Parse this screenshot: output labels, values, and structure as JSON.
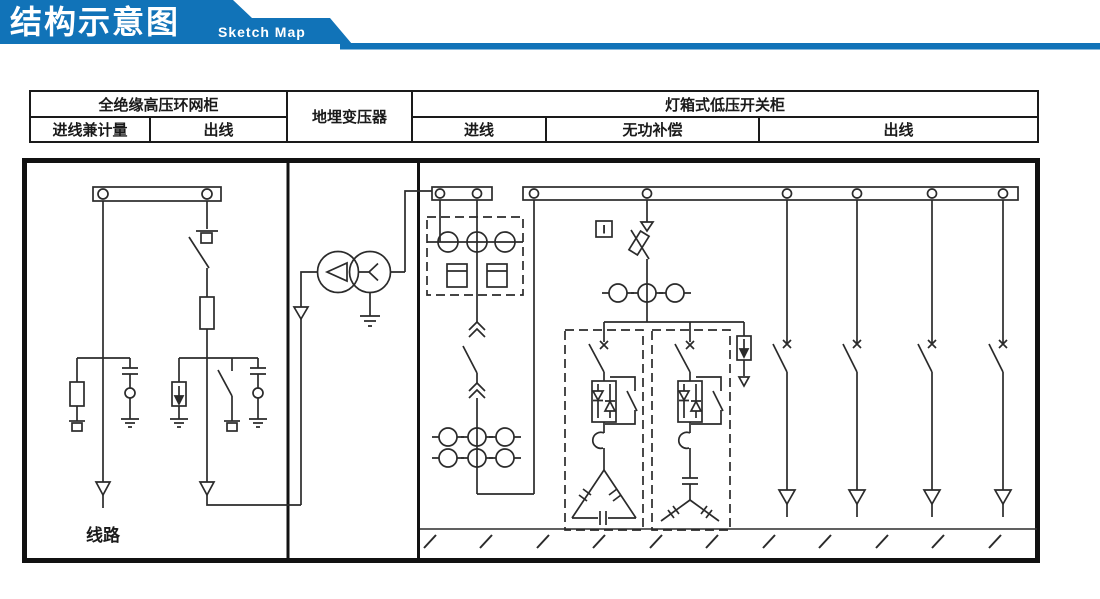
{
  "banner": {
    "title_cn": "结构示意图",
    "title_en": "Sketch Map",
    "color": "#1173b8"
  },
  "header_table": {
    "sections": [
      {
        "title": "全绝缘高压环网柜",
        "columns": [
          "进线兼计量",
          "出线"
        ]
      },
      {
        "title": "地埋变压器",
        "columns": []
      },
      {
        "title": "灯箱式低压开关柜",
        "columns": [
          "进线",
          "无功补偿",
          "出线"
        ]
      }
    ]
  },
  "diagram": {
    "line_label": "线路",
    "indicator_label": "I",
    "stroke_color": "#2b2b2b",
    "sections": [
      "全绝缘高压环网柜",
      "地埋变压器",
      "灯箱式低压开关柜"
    ],
    "symbols": [
      "busbar",
      "load-break-switch",
      "fuse",
      "voltage-transformer",
      "surge-arrester",
      "earth",
      "line-arrow",
      "transformer-delta-wye",
      "current-transformer",
      "energy-meter",
      "drawout-breaker",
      "circuit-breaker",
      "fuse-switch",
      "thyristor-module",
      "reactor",
      "capacitor-bank-delta",
      "capacitor-bank-wye",
      "ground-hatch"
    ]
  }
}
